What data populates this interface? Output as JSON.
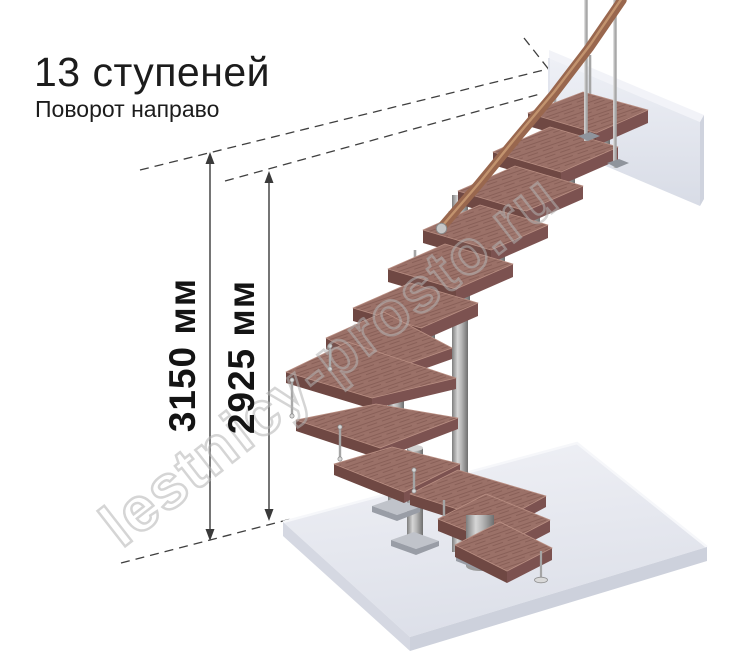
{
  "header": {
    "title": "13 ступеней",
    "subtitle": "Поворот направо"
  },
  "dimensions": {
    "total_height": "3150 мм",
    "stair_height": "2925 мм"
  },
  "watermark": "lestnicy-prosto.ru",
  "stairs": {
    "steps_count": 13,
    "turn_direction": "направо"
  },
  "colors": {
    "text": "#1c1c1c",
    "dimension_lines": "#3f3f3f",
    "wood_step_top": "#9b7168",
    "wood_step_front": "#7c5250",
    "handrail": "#99674e",
    "metal_light": "#d6d6d6",
    "metal_dark": "#6e6e6e",
    "floor_slab": "#e9ebf2",
    "watermark": "#c8c8c8"
  }
}
